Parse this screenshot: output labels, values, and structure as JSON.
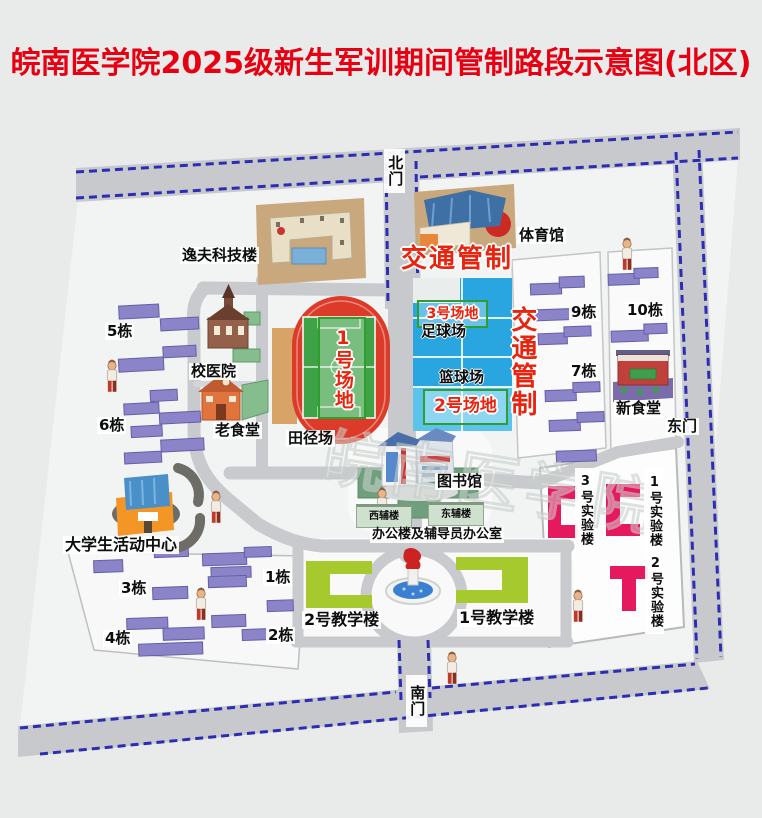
{
  "title": "皖南医学院2025级新生军训期间管制路段示意图(北区)",
  "watermark": "皖南医学院",
  "gates": {
    "north": "北门",
    "south": "南门",
    "east": "东门"
  },
  "traffic_control": {
    "north": "交通管制",
    "east": "交通管制"
  },
  "venues": {
    "venue1": "1号场地",
    "venue2": "2号场地",
    "venue3": "3号场地",
    "track": "田径场",
    "football": "足球场",
    "basketball": "篮球场"
  },
  "buildings": {
    "yifu_science_building": "逸夫科技楼",
    "gymnasium": "体育馆",
    "school_hospital": "校医院",
    "old_canteen": "老食堂",
    "new_canteen": "新食堂",
    "library": "图书馆",
    "student_activity_center": "大学生活动中心",
    "west_annex": "西辅楼",
    "east_annex": "东辅楼",
    "office_and_counselor_office": "办公楼及辅导员办公室",
    "teaching_building_1": "1号教学楼",
    "teaching_building_2": "2号教学楼",
    "lab_building_1": "1号实验楼",
    "lab_building_2": "2号实验楼",
    "lab_building_3": "3号实验楼"
  },
  "dorms": {
    "dorm_1": "1栋",
    "dorm_2": "2栋",
    "dorm_3": "3栋",
    "dorm_4": "4栋",
    "dorm_5": "5栋",
    "dorm_6": "6栋",
    "dorm_7": "7栋",
    "dorm_9": "9栋",
    "dorm_10": "10栋"
  },
  "colors": {
    "title_red": "#e60012",
    "control_red": "#e8240e",
    "road_gray": "#c8c9cc",
    "dash_blue": "#2d2db4",
    "track_red": "#dc3b29",
    "field_green": "#3fa247",
    "court_blue": "#29a5df",
    "court_light_blue": "#5cc4ec",
    "dorm_purple": "#8c84c8",
    "lab_pink": "#e5195e",
    "teaching_green": "#a6ca2d",
    "venue_box_green": "#2f9e2f"
  }
}
